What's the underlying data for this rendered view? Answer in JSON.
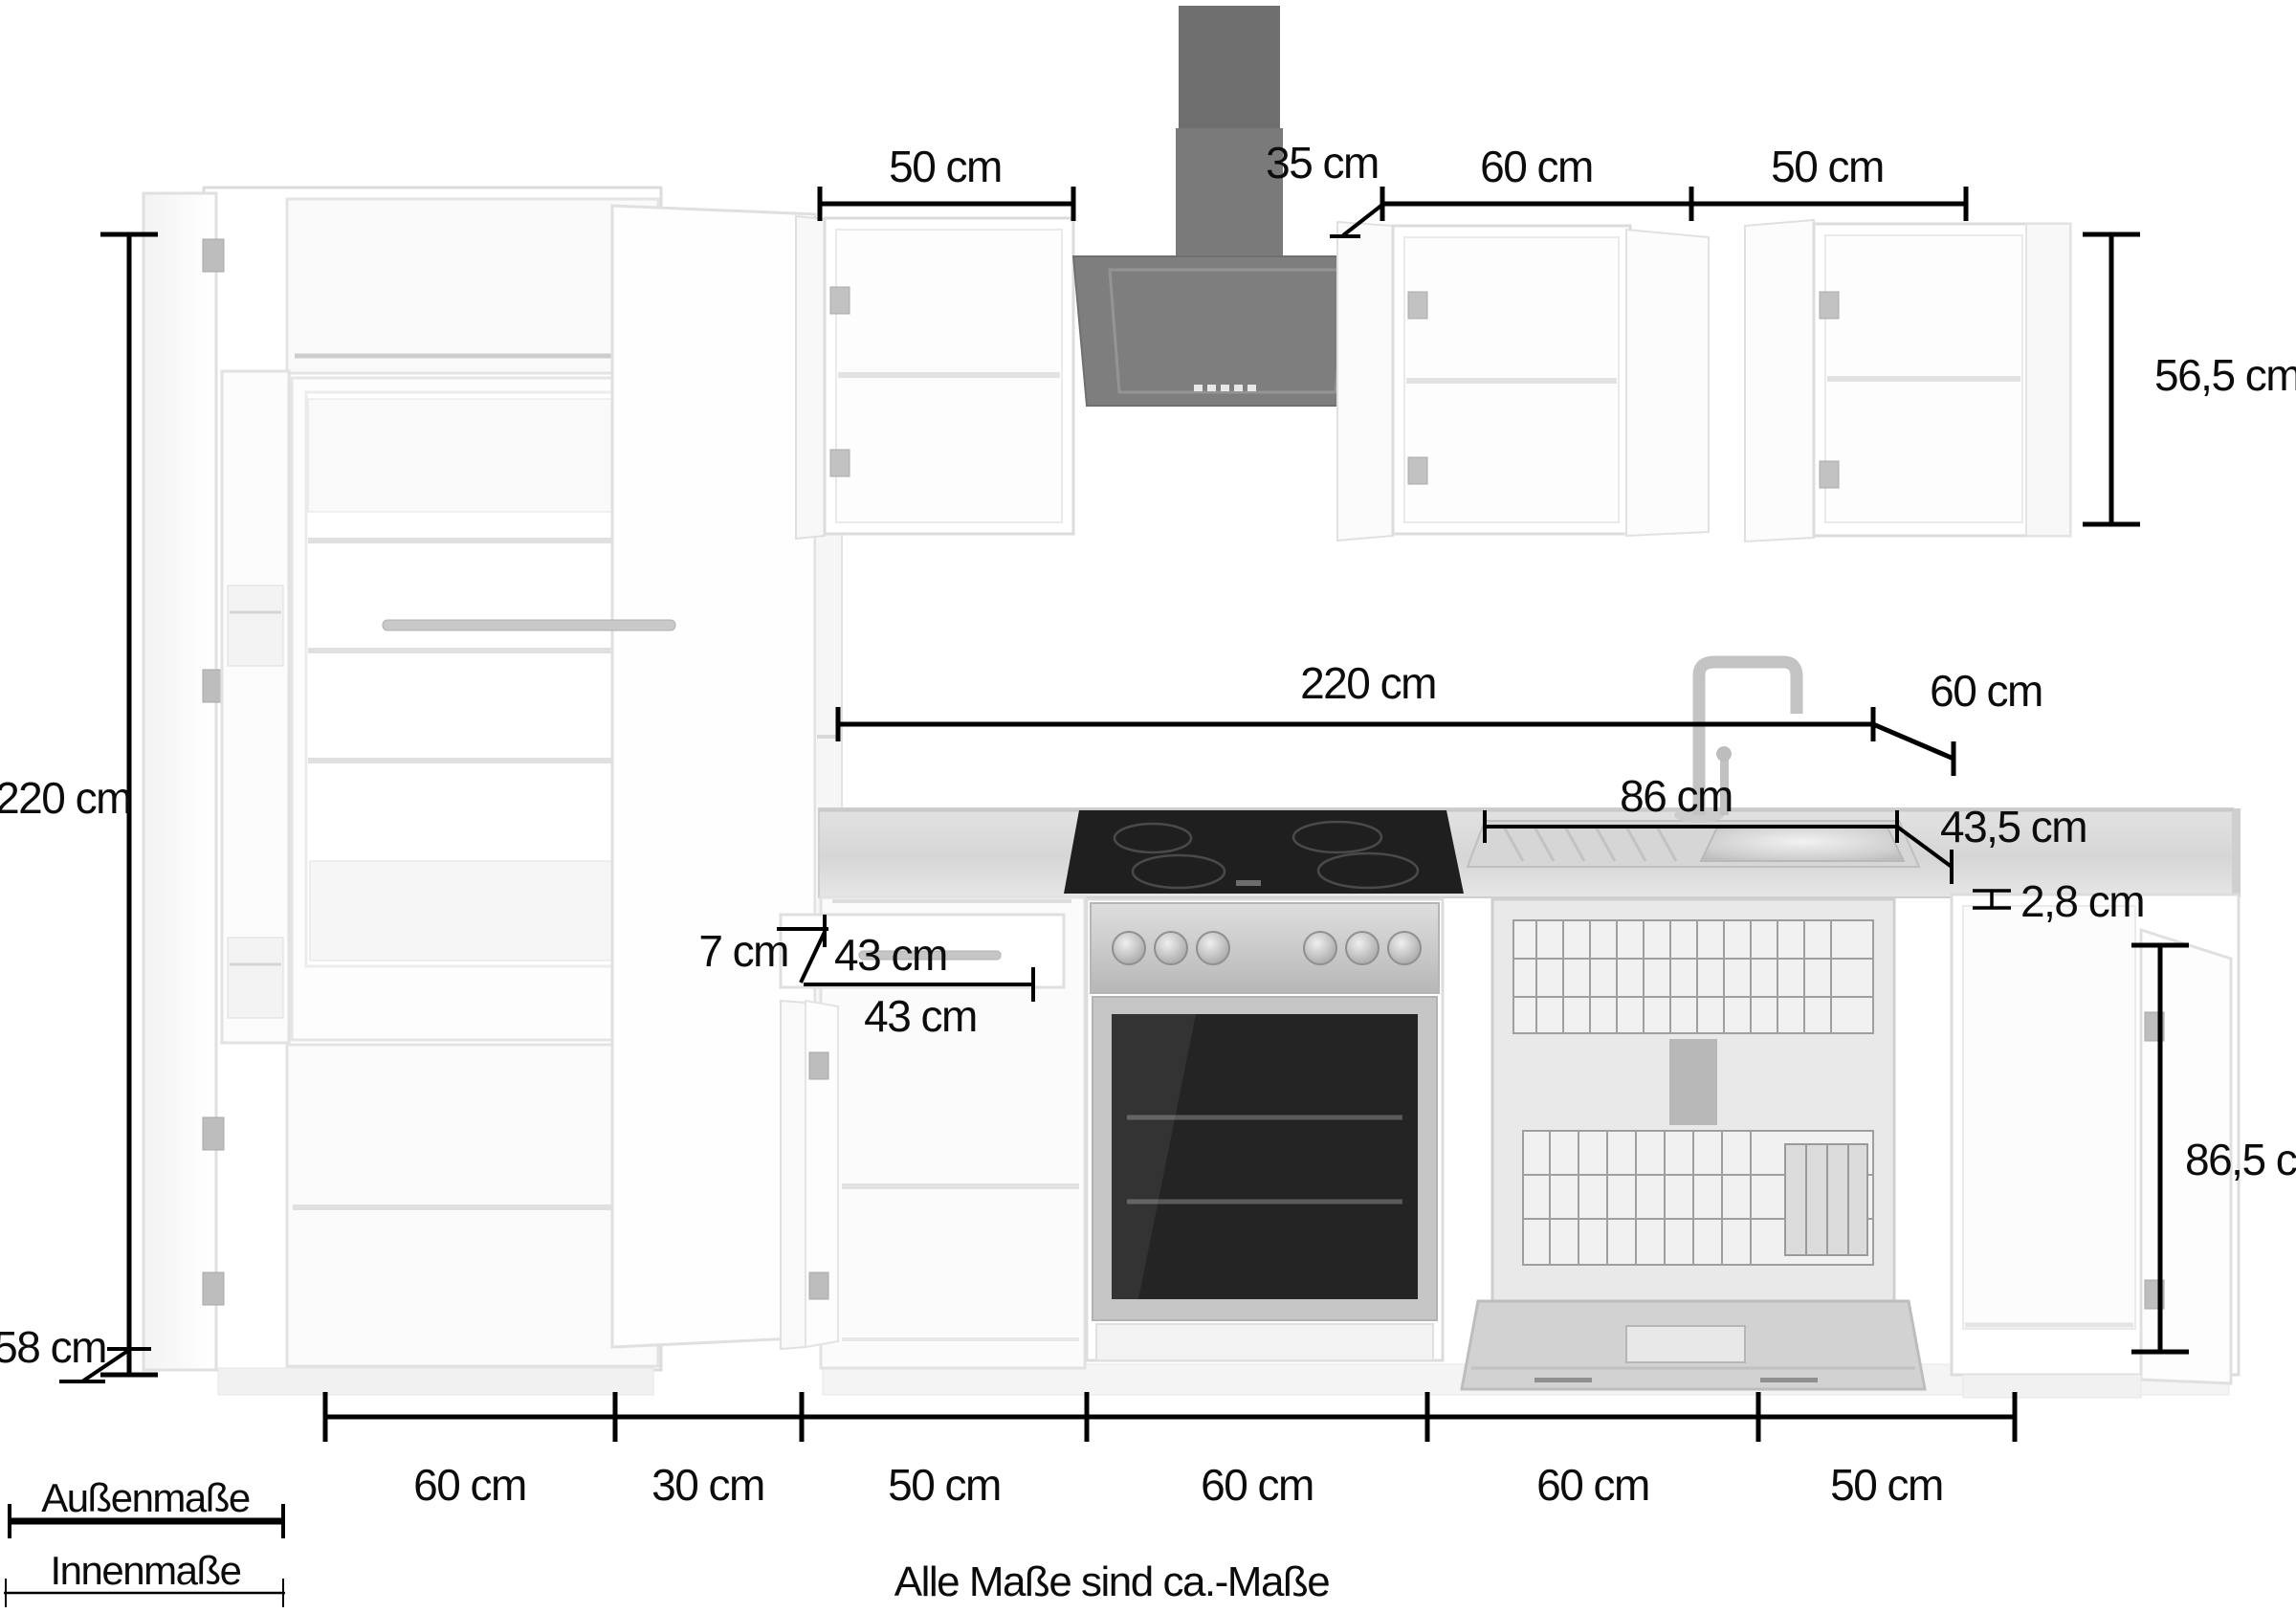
{
  "dimensions": {
    "left_total_height": "220 cm",
    "tall_cabinet_depth": "58 cm",
    "wall_cabinet_left_width": "50 cm",
    "hood_width": "35 cm",
    "wall_cabinet_60_width": "60 cm",
    "wall_cabinet_right_width": "50 cm",
    "wall_cabinet_height": "56,5 cm",
    "run_length": "220 cm",
    "worktop_depth": "60 cm",
    "sink_length": "86 cm",
    "sink_depth": "43,5 cm",
    "worktop_thickness": "2,8 cm",
    "drawer_front_height": "7 cm",
    "drawer_depth": "43 cm",
    "drawer_width": "43 cm",
    "base_cabinet_height": "86,5 cm"
  },
  "bottom_scale": {
    "segments": [
      "60 cm",
      "30 cm",
      "50 cm",
      "60 cm",
      "60 cm",
      "50 cm"
    ]
  },
  "legend": {
    "outer_label": "Außenmaße",
    "inner_label": "Innenmaße"
  },
  "footer": {
    "note": "Alle Maße sind ca.-Maße"
  },
  "colors": {
    "dimension_line": "#000000",
    "hood_dark": "#7e7e7e",
    "hob_black": "#1f1f1f",
    "cabinet_white": "#ffffff",
    "worktop_gray": "#dadada",
    "stainless": "#c6c6c6"
  }
}
